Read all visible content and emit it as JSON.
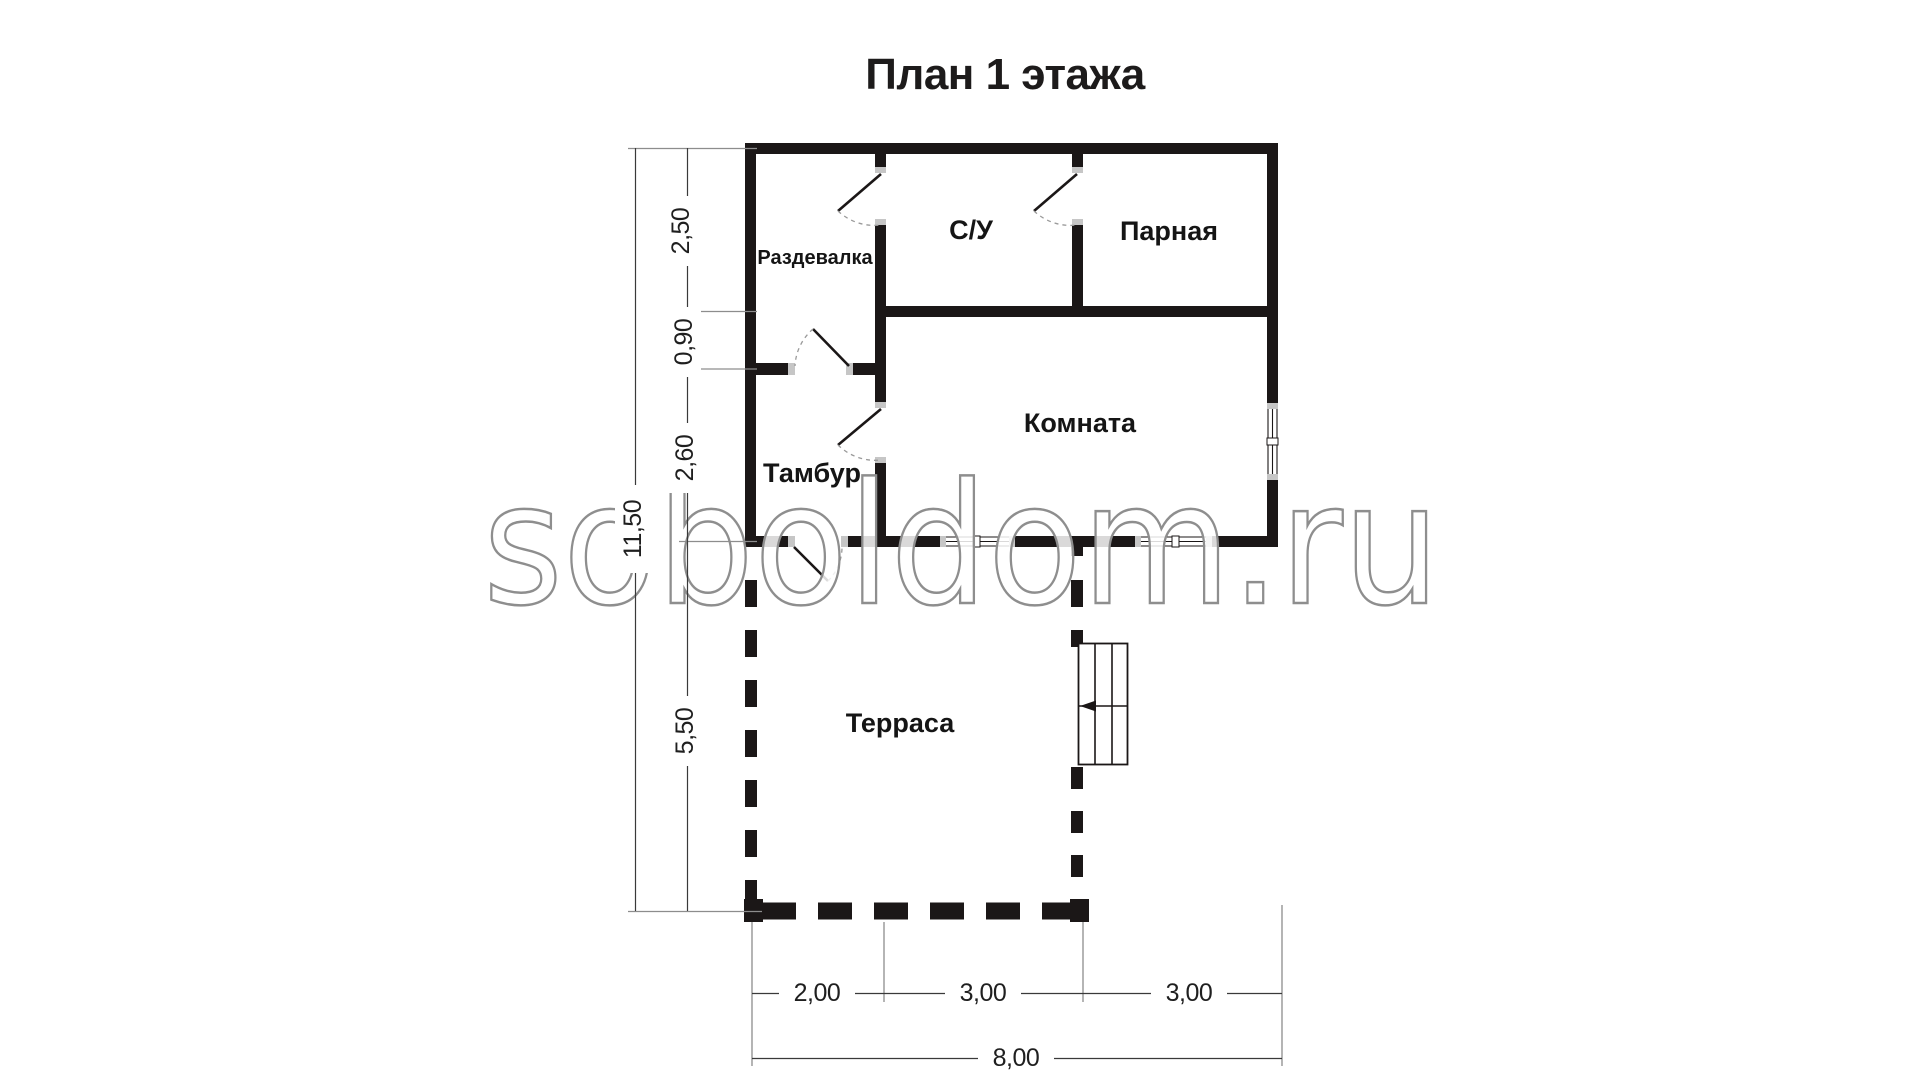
{
  "title": "План 1 этажа",
  "watermark": "soboldom.ru",
  "rooms": {
    "razdevalka": "Раздевалка",
    "su": "С/У",
    "parnaya": "Парная",
    "komnata": "Комната",
    "tambur": "Тамбур",
    "terrasa": "Терраса"
  },
  "dimensions": {
    "left": {
      "total": "11,50",
      "seg1": "2,50",
      "seg2": "0,90",
      "seg3": "2,60",
      "seg4": "5,50"
    },
    "bottom": {
      "total": "8,00",
      "seg1": "2,00",
      "seg2": "3,00",
      "seg3": "3,00"
    }
  },
  "colors": {
    "wall": "#1b1717",
    "jamb_cap": "#c6c6c6",
    "dim_line": "#3a3a3a",
    "extension_line": "#8d8d8d",
    "door_arc": "#9a9a9a",
    "watermark_outline": "#8e8e8e",
    "text": "#1a1a1a"
  }
}
